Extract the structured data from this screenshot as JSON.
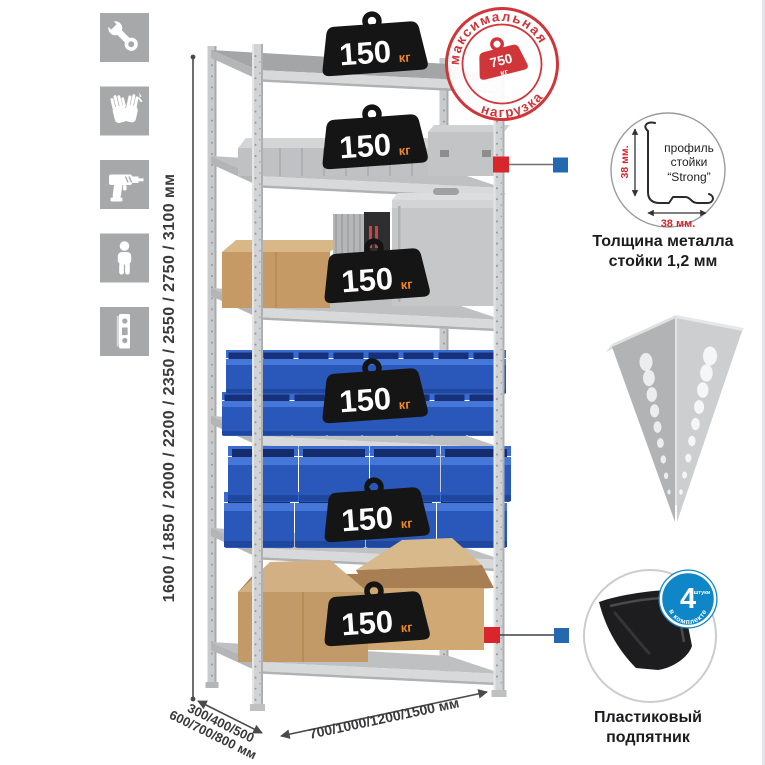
{
  "feature_icons": [
    {
      "name": "wrench-icon"
    },
    {
      "name": "gloves-icon"
    },
    {
      "name": "drill-icon"
    },
    {
      "name": "person-icon"
    },
    {
      "name": "upright-profile-icon"
    }
  ],
  "dimensions": {
    "height_label": "1600 / 1850 / 2000 / 2200 / 2350 / 2550 / 2750 / 3100 мм",
    "width_label": "700/1000/1200/1500 мм",
    "depth_label_line1": "300/400/500",
    "depth_label_line2": "600/700/800 мм"
  },
  "shelf_load_badge": {
    "value": "150",
    "unit": "кг"
  },
  "max_load_stamp": {
    "arc_top": "максимальная",
    "arc_bottom": "нагрузка",
    "value": "750",
    "unit": "кг"
  },
  "profile_detail": {
    "label_line1": "профиль",
    "label_line2": "стойки",
    "label_line3": "“Strong”",
    "height_dim": "38 мм.",
    "width_dim": "38 мм.",
    "caption_line1": "Толщина металла",
    "caption_line2": "стойки 1,2 мм"
  },
  "foot_detail": {
    "badge_value": "4",
    "badge_small_text": "штуки",
    "badge_arc_text": "в комплекте",
    "caption_line1": "Пластиковый",
    "caption_line2": "подпятник"
  },
  "colors": {
    "accent_red": "#d0353a",
    "accent_blue": "#2468b0",
    "bin_blue": "#2a58ba",
    "metal_gray": "#cdced0",
    "icon_gray": "#a7a8aa",
    "badge_black": "#151515",
    "kg_orange": "#f08428"
  }
}
